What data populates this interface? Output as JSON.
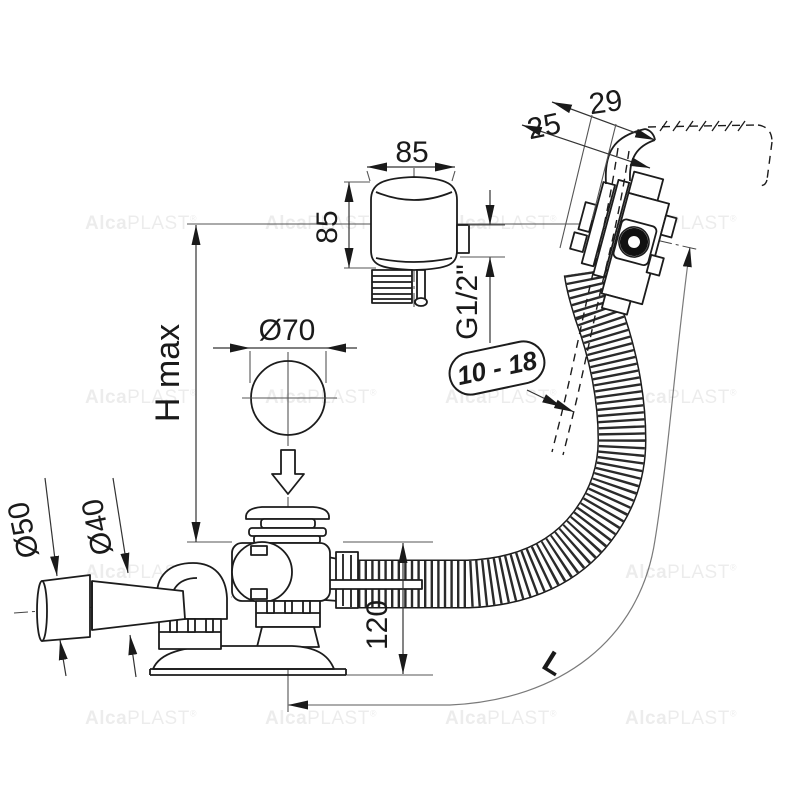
{
  "labels": {
    "dim_29": "29",
    "dim_25": "25",
    "box_width": "85",
    "box_height": "85",
    "thread_size": "G1/2\"",
    "plug_diameter": "Ø70",
    "height_max": "H max",
    "wall_range": "10 - 18",
    "outlet_dia": "Ø50",
    "pipe_dia": "Ø40",
    "body_height": "120",
    "hose_length": "L"
  },
  "watermark": {
    "bold": "Alca",
    "rest": "PLAST",
    "reg": "®"
  }
}
